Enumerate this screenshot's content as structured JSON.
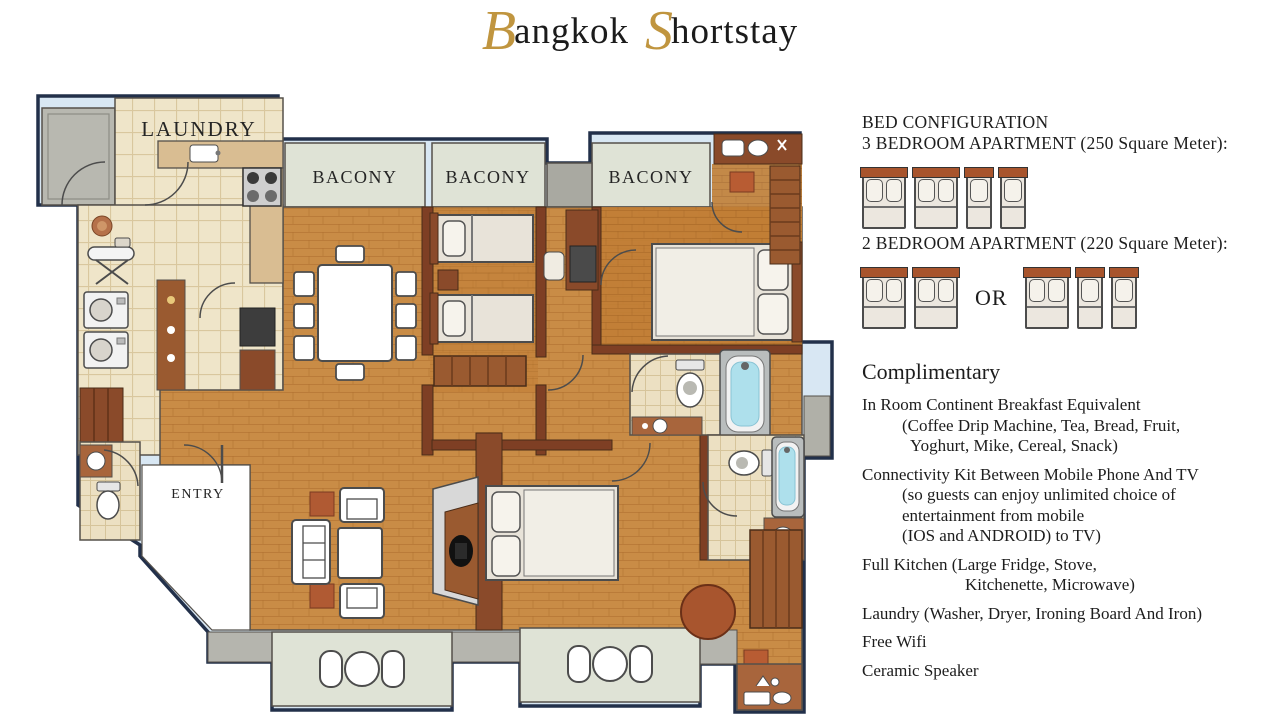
{
  "title": {
    "initial_b": "B",
    "rest_b": "angkok",
    "initial_s": "S",
    "rest_s": "hortstay"
  },
  "floor_plan": {
    "labels": {
      "laundry": "LAUNDRY",
      "balcony1": "BACONY",
      "balcony2": "BACONY",
      "balcony3": "BACONY",
      "entry": "ENTRY"
    },
    "colors": {
      "outline": "#22304a",
      "outer_band": "#d8e7f3",
      "wood": "#c98c46",
      "tile": "#efe5c9",
      "balcony": "#dfe3d6",
      "wall_brown": "#8a4a2a",
      "bath_water": "#aee0ec"
    }
  },
  "bed_configuration": {
    "heading": "BED CONFIGURATION",
    "apartment_3br": {
      "title": "3 BEDROOM APARTMENT (250 Square Meter):",
      "beds": [
        "double",
        "double",
        "single",
        "single"
      ]
    },
    "apartment_2br": {
      "title": "2 BEDROOM APARTMENT (220 Square Meter):",
      "option1": [
        "double",
        "double"
      ],
      "or_label": "OR",
      "option2": [
        "double",
        "single",
        "single"
      ]
    }
  },
  "complimentary": {
    "heading": "Complimentary",
    "lines": [
      {
        "t": "In Room Continent Breakfast Equivalent",
        "ind": 0,
        "gap": false
      },
      {
        "t": "(Coffee Drip Machine, Tea, Bread, Fruit,",
        "ind": 1,
        "gap": false
      },
      {
        "t": "Yoghurt, Mike, Cereal, Snack)",
        "ind": 2,
        "gap": false
      },
      {
        "t": "Connectivity Kit Between Mobile Phone And TV",
        "ind": 0,
        "gap": true
      },
      {
        "t": "(so guests can enjoy unlimited choice of",
        "ind": 1,
        "gap": false
      },
      {
        "t": "entertainment from mobile",
        "ind": 1,
        "gap": false
      },
      {
        "t": "(IOS and ANDROID) to TV)",
        "ind": 1,
        "gap": false
      },
      {
        "t": "Full Kitchen (Large Fridge, Stove,",
        "ind": 0,
        "gap": true
      },
      {
        "t": "Kitchenette, Microwave)",
        "ind": 3,
        "gap": false
      },
      {
        "t": "Laundry (Washer, Dryer, Ironing Board And Iron)",
        "ind": 0,
        "gap": true
      },
      {
        "t": "Free Wifi",
        "ind": 0,
        "gap": true
      },
      {
        "t": "Ceramic Speaker",
        "ind": 0,
        "gap": true
      }
    ]
  }
}
